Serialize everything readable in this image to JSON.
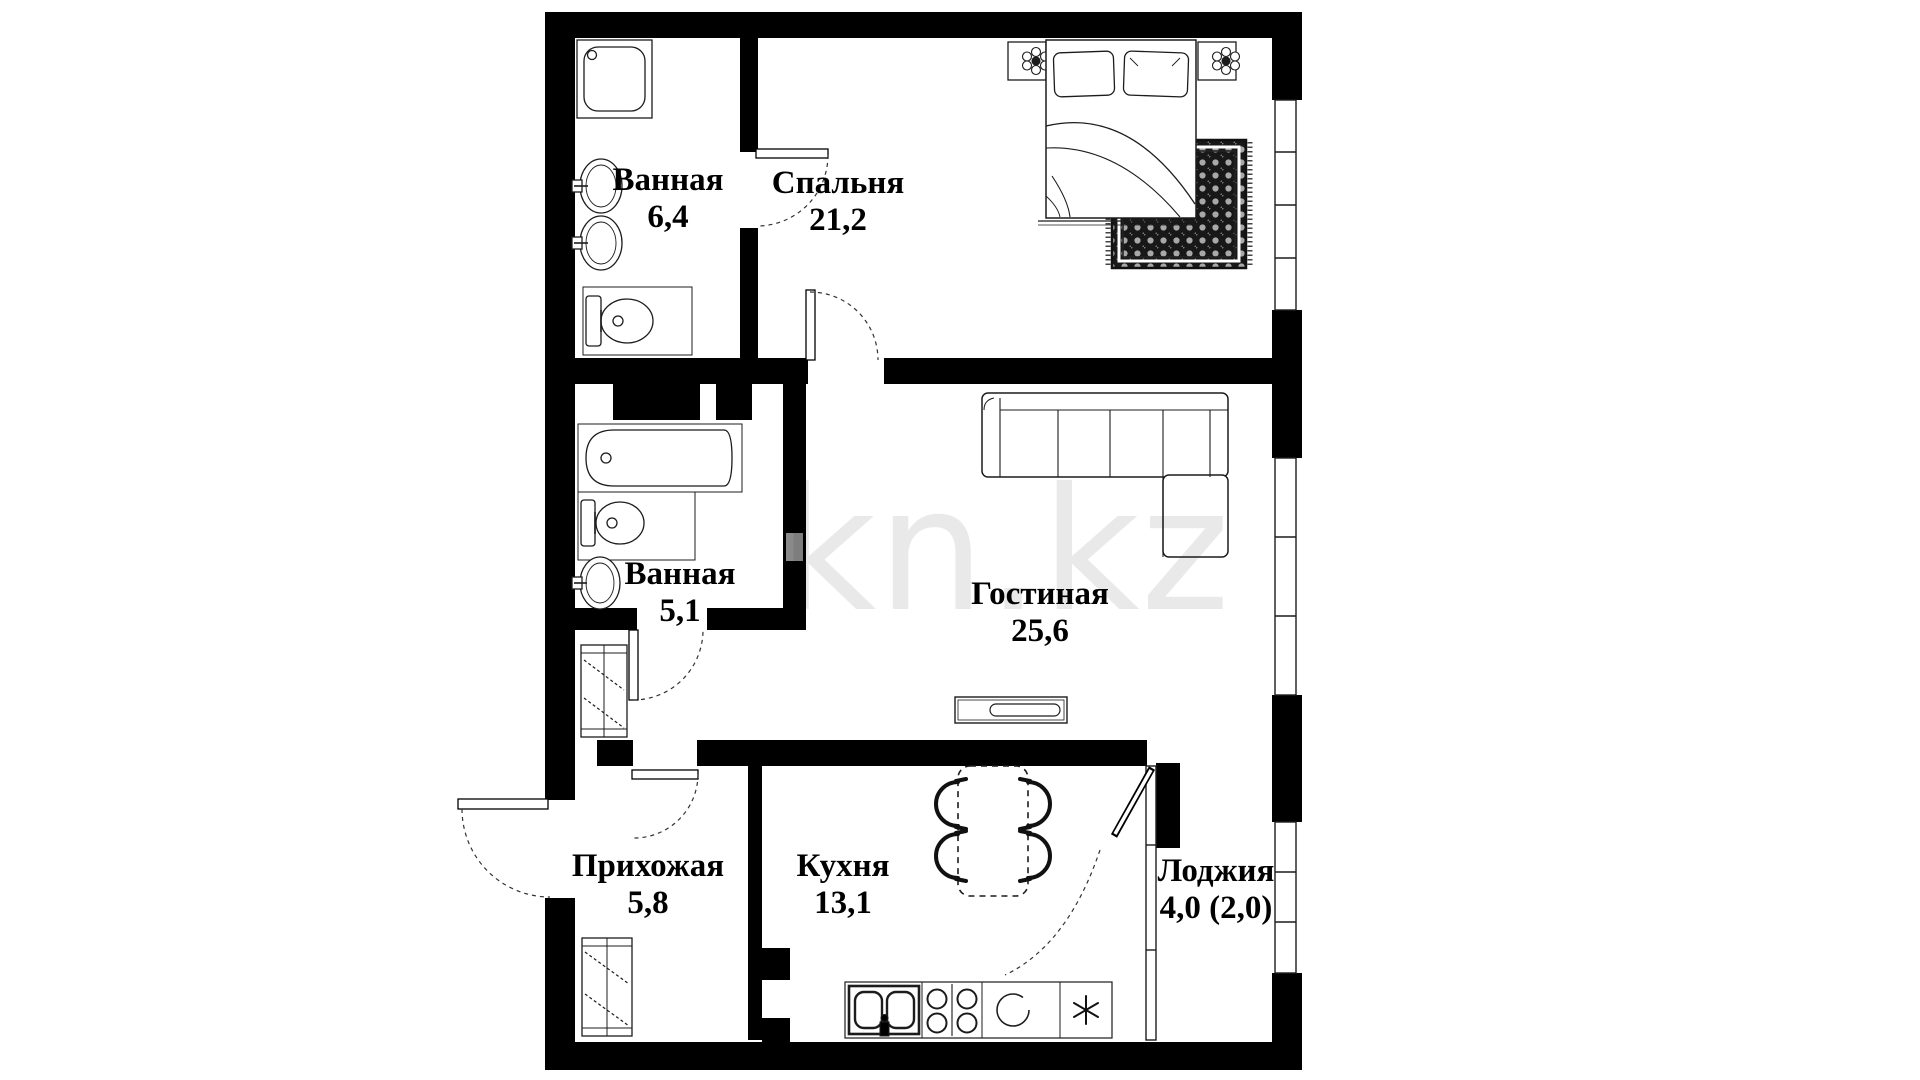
{
  "watermark": {
    "text": "kn.kz",
    "color": "#e9e9e9"
  },
  "rooms": {
    "bathroom1": {
      "name": "Ванная",
      "area": "6,4"
    },
    "bedroom": {
      "name": "Спальня",
      "area": "21,2"
    },
    "bathroom2": {
      "name": "Ванная",
      "area": "5,1"
    },
    "living": {
      "name": "Гостиная",
      "area": "25,6"
    },
    "hallway": {
      "name": "Прихожая",
      "area": "5,8"
    },
    "kitchen": {
      "name": "Кухня",
      "area": "13,1"
    },
    "loggia": {
      "name": "Лоджия",
      "area": "4,0 (2,0)"
    }
  },
  "colors": {
    "wall": "#000000",
    "line": "#1c1c1c",
    "background": "#ffffff",
    "watermark": "#e9e9e9",
    "rug_dark": "#181818"
  },
  "icons": {
    "shower": "rounded-square-with-drain",
    "washbasin": "oval-with-tap",
    "toilet": "tank-and-bowl",
    "bathtub": "rounded-tub-with-drain",
    "bed": "rect-with-pillows-and-blanket",
    "nightstand-lamp": "square-with-flower",
    "rug": "dark-woven-rect",
    "corner-sofa": "l-shaped-sectional",
    "tv-stand": "rect-with-tv",
    "dining-table": "dashed-rect",
    "chair": "thick-c-arc",
    "wardrobe": "rect-with-hangers",
    "kitchen-sink": "double-bowl",
    "stove": "four-burners",
    "oven": "open-circle",
    "fridge": "snowflake-asterisk",
    "door-swing": "dashed-quarter-arc",
    "window": "double-line-with-ticks"
  }
}
